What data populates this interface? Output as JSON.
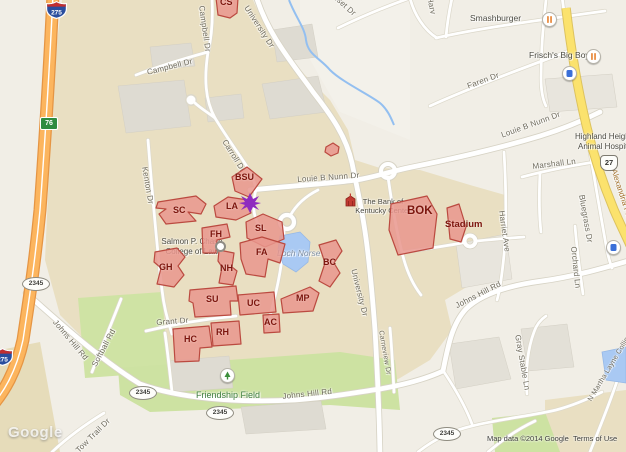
{
  "road_labels": {
    "university_dr_top": "University Dr",
    "university_dr_south": "University Dr",
    "campbell_dr_v": "Campbell Dr",
    "campbell_dr": "Campbell Dr",
    "carroll_dr": "Carroll Dr",
    "kenton_dr": "Kenton Dr",
    "nunn_dr_west": "Louie B Nunn Dr",
    "nunn_dr_east": "Louie B Nunn Dr",
    "sunset_dr": "Sunset Dr",
    "harv_partial": "Harv",
    "faren_dr": "Faren Dr",
    "marshall_ln": "Marshall Ln",
    "alexandria_pike": "Alexandria Pike",
    "bluegrass_dr": "Bluegrass Dr",
    "orchard_ln": "Orchard Ln",
    "harriet_ave": "Harriet Ave",
    "johns_hill_east": "Johns Hill Rd",
    "johns_hill_south": "Johns Hill Rd",
    "johns_hill_west": "Johns Hill Rd",
    "gray_stable_ln": "Gray Stable Ln",
    "martha_layne_collins": "N Martha Layne Collins",
    "softball_rd": "Softball Rd",
    "tow_trail_dr": "Tow Trail Dr",
    "grant_dr": "Grant Dr",
    "carneview_dr": "Carneview Dr"
  },
  "places": {
    "smashburger": "Smashburger",
    "frischs": "Frisch's Big Boy",
    "highland1": "Highland Heights",
    "highland2": "Animal Hospital",
    "chase1": "Salmon P. Chase",
    "chase2": "College of Law",
    "bank1": "The Bank of",
    "bank2": "Kentucky Center",
    "loch_norse": "Loch Norse",
    "friendship_field": "Friendship Field"
  },
  "buildings": {
    "cs": "CS",
    "bsu": "BSU",
    "sc": "SC",
    "la": "LA",
    "fh": "FH",
    "sl": "SL",
    "gh": "GH",
    "nh": "NH",
    "fa": "FA",
    "bc": "BC",
    "su": "SU",
    "uc": "UC",
    "mp": "MP",
    "ac": "AC",
    "rh": "RH",
    "hc": "HC",
    "bok": "BOK",
    "stadium": "Stadium"
  },
  "shields": {
    "interstate": "275",
    "exit": "76",
    "us27": "27",
    "ky2345": "2345"
  },
  "attribution": {
    "map_data": "Map data ©2014 Google",
    "terms": "Terms of Use",
    "watermark": "Google"
  },
  "colors": {
    "building_fill": "#e9968d",
    "building_stroke": "#bb4a40",
    "building_label": "#7c150d",
    "highway_orange": "#fcb55e",
    "highway_yellow": "#fbe26d",
    "water": "#a9c9f3",
    "park": "#cfe3a4",
    "campus_land": "#e9dfc2",
    "star": "#8e2bbf"
  }
}
